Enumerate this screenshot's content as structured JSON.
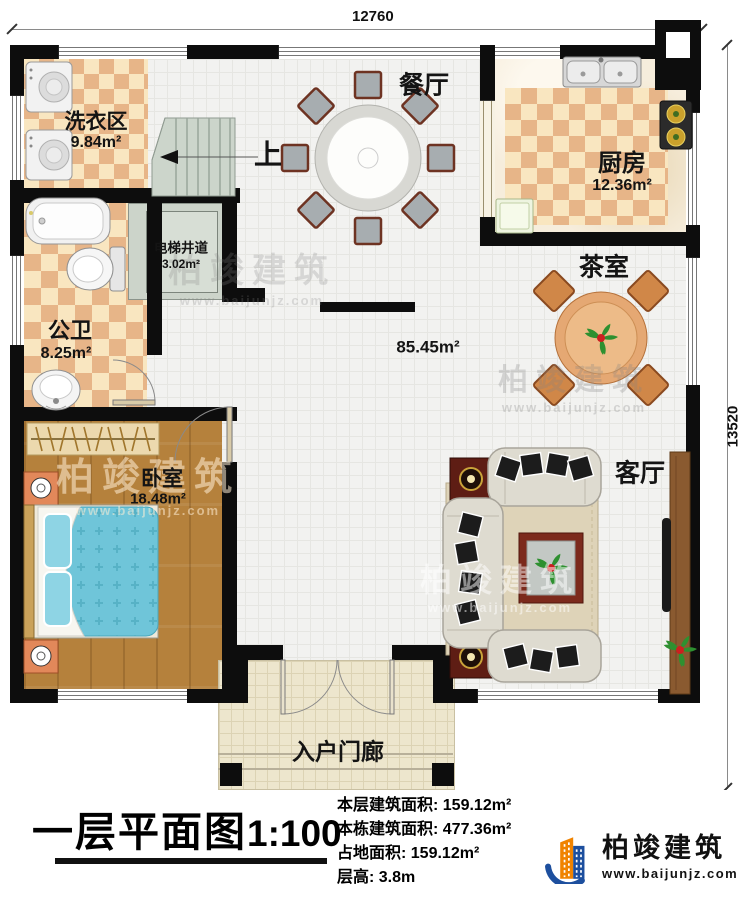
{
  "watermark": {
    "name": "柏竣建筑",
    "url": "www.baijunjz.com"
  },
  "dims": {
    "top": "12760",
    "right": "13520"
  },
  "rooms": {
    "laundry": {
      "label": "洗衣区",
      "area": "9.84m²"
    },
    "dining": {
      "label": "餐厅"
    },
    "kitchen": {
      "label": "厨房",
      "area": "12.36m²"
    },
    "elevator": {
      "label": "电梯井道",
      "area": "3.02m²"
    },
    "bath": {
      "label": "公卫",
      "area": "8.25m²"
    },
    "hall": {
      "area": "85.45m²"
    },
    "tea": {
      "label": "茶室"
    },
    "bedroom": {
      "label": "卧室",
      "area": "18.48m²"
    },
    "living": {
      "label": "客厅"
    },
    "porch": {
      "label": "入户门廊"
    },
    "stairs": {
      "label": "上"
    }
  },
  "footer": {
    "title": "一层平面图",
    "scale": "1:100",
    "stats": [
      "本层建筑面积: 159.12m²",
      "本栋建筑面积: 477.36m²",
      "占地面积: 159.12m²",
      "层高: 3.8m"
    ],
    "logo": {
      "name": "柏竣建筑",
      "url": "www.baijunjz.com"
    }
  },
  "colors": {
    "wall": "#0d0d0d",
    "checker_dark": "#e7b588",
    "checker_light": "#f9e6c0",
    "wood": "#b5813c",
    "bed_blue": "#6fc5d9",
    "stair_gray": "#ccd5cb",
    "logo_blue": "#1d4f9e",
    "logo_orange": "#f08300"
  }
}
